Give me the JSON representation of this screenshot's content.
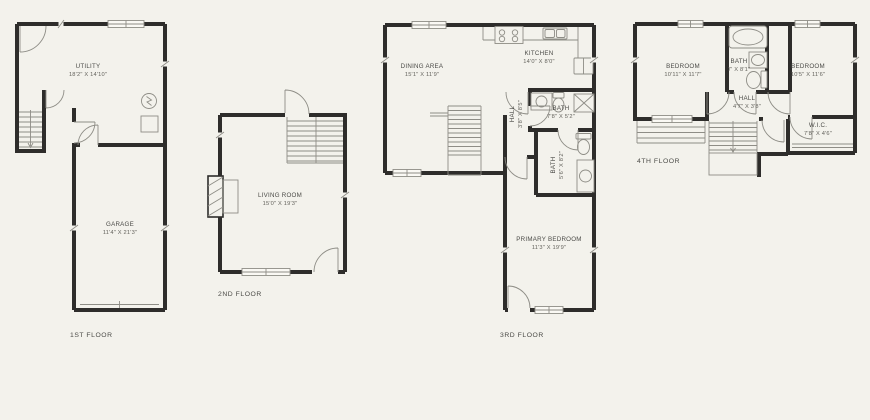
{
  "canvas": {
    "background": "#f3f2ec",
    "wall_color": "#2e2d2b",
    "line_color": "#8e8d86",
    "label_color": "#4b4b47",
    "dim_color": "#63625c"
  },
  "floors": [
    {
      "id": "1st",
      "label": "1ST FLOOR",
      "rooms": [
        {
          "name": "UTILITY",
          "dims": "18'2\" X 14'10\""
        },
        {
          "name": "GARAGE",
          "dims": "11'4\" X 21'3\""
        }
      ],
      "fixtures": [
        "stairs",
        "electrical-panel",
        "garage-door",
        "windows",
        "doors"
      ]
    },
    {
      "id": "2nd",
      "label": "2ND FLOOR",
      "rooms": [
        {
          "name": "LIVING ROOM",
          "dims": "15'0\" X 19'3\""
        }
      ],
      "fixtures": [
        "stairs",
        "fireplace",
        "windows",
        "doors"
      ]
    },
    {
      "id": "3rd",
      "label": "3RD FLOOR",
      "rooms": [
        {
          "name": "DINING AREA",
          "dims": "15'1\" X 11'9\""
        },
        {
          "name": "KITCHEN",
          "dims": "14'0\" X 8'0\""
        },
        {
          "name": "BATH",
          "dims": "7'8\" X 5'2\""
        },
        {
          "name": "HALL",
          "dims": "3'8\" X 8'5\""
        },
        {
          "name": "BATH",
          "dims": "5'6\" X 8'2\""
        },
        {
          "name": "PRIMARY BEDROOM",
          "dims": "11'3\" X 19'9\""
        }
      ],
      "fixtures": [
        "stairs",
        "stove",
        "kitchen-sink",
        "refrigerator",
        "shower",
        "toilets",
        "vanity-sinks",
        "windows",
        "doors"
      ]
    },
    {
      "id": "4th",
      "label": "4TH FLOOR",
      "rooms": [
        {
          "name": "BEDROOM",
          "dims": "10'11\" X 11'7\""
        },
        {
          "name": "BATH",
          "dims": "7' X 8'1\""
        },
        {
          "name": "BEDROOM",
          "dims": "10'5\" X 11'6\""
        },
        {
          "name": "HALL",
          "dims": "4'7\" X 3'8\""
        },
        {
          "name": "W.I.C.",
          "dims": "7'8\" X 4'6\""
        }
      ],
      "fixtures": [
        "stairs",
        "bathtub",
        "vanity-sink",
        "toilet",
        "closet-rod",
        "windows",
        "doors"
      ]
    }
  ]
}
